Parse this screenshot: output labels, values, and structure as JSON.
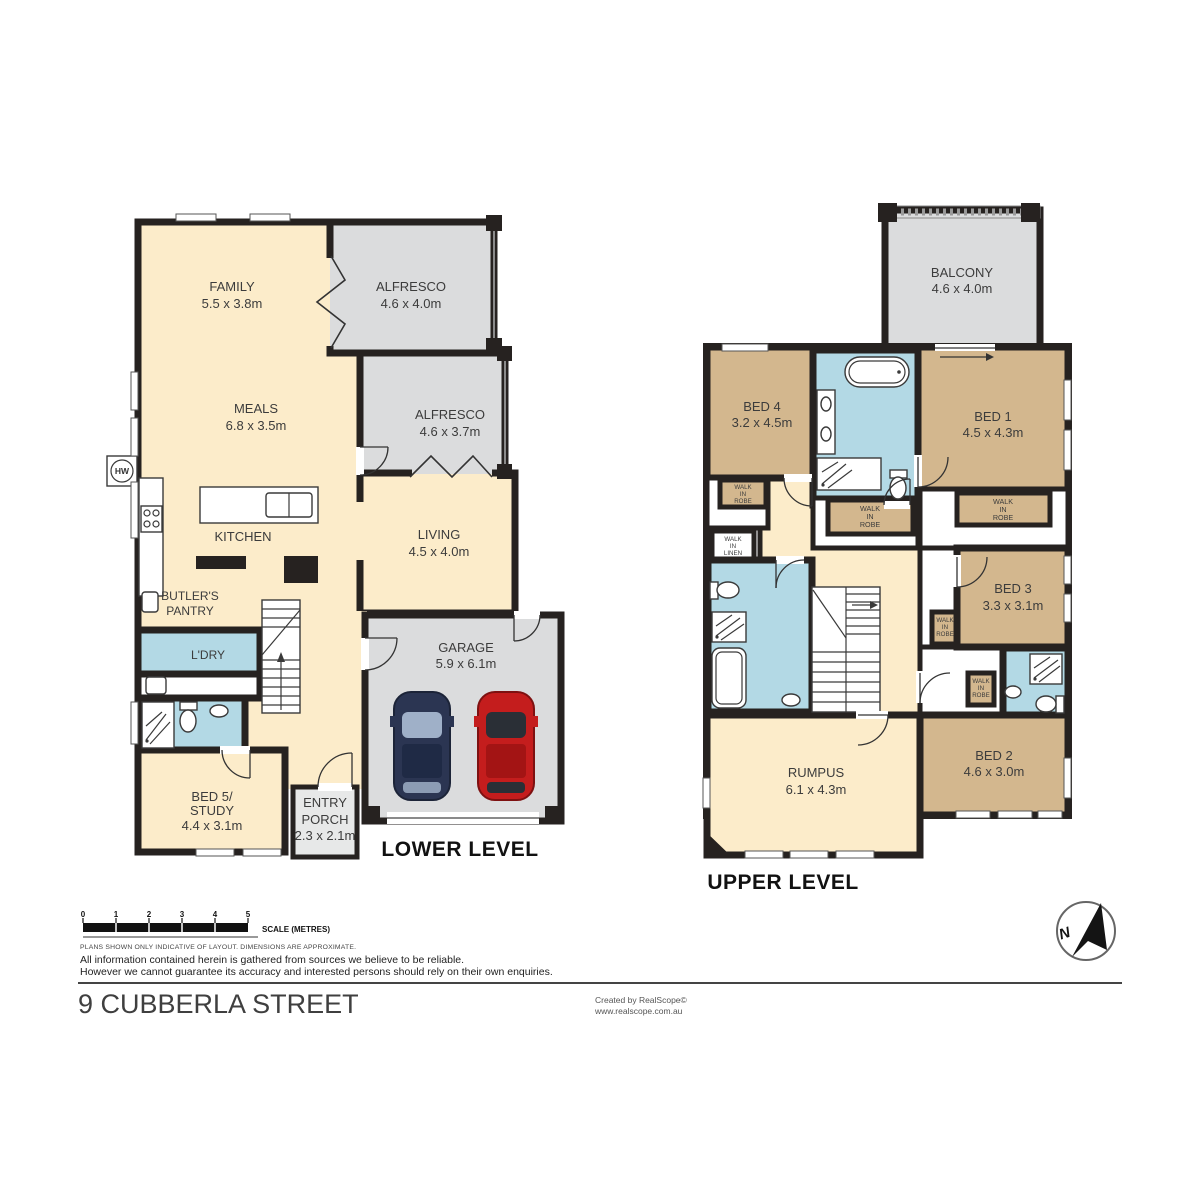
{
  "page": {
    "address": "9 CUBBERLA STREET",
    "credit_line1": "Created by RealScope©",
    "credit_line2": "www.realscope.com.au"
  },
  "levels": {
    "lower": {
      "title": "LOWER LEVEL",
      "rooms": {
        "family": {
          "name": "FAMILY",
          "dims": "5.5 x 3.8m"
        },
        "alfresco_top": {
          "name": "ALFRESCO",
          "dims": "4.6 x 4.0m"
        },
        "meals": {
          "name": "MEALS",
          "dims": "6.8 x 3.5m"
        },
        "alfresco_mid": {
          "name": "ALFRESCO",
          "dims": "4.6 x 3.7m"
        },
        "kitchen": {
          "name": "KITCHEN"
        },
        "living": {
          "name": "LIVING",
          "dims": "4.5 x 4.0m"
        },
        "butlers_pantry": {
          "name1": "BUTLER'S",
          "name2": "PANTRY"
        },
        "laundry": {
          "name": "L'DRY"
        },
        "garage": {
          "name": "GARAGE",
          "dims": "5.9 x 6.1m"
        },
        "bed5_study": {
          "name1": "BED 5/",
          "name2": "STUDY",
          "dims": "4.4 x 3.1m"
        },
        "entry_porch": {
          "name1": "ENTRY",
          "name2": "PORCH",
          "dims": "2.3 x 2.1m"
        },
        "hot_water": {
          "abbr": "HW"
        }
      }
    },
    "upper": {
      "title": "UPPER LEVEL",
      "rooms": {
        "balcony": {
          "name": "BALCONY",
          "dims": "4.6 x 4.0m"
        },
        "bed4": {
          "name": "BED 4",
          "dims": "3.2 x 4.5m"
        },
        "bed1": {
          "name": "BED 1",
          "dims": "4.5 x 4.3m"
        },
        "bed3": {
          "name": "BED 3",
          "dims": "3.3 x 3.1m"
        },
        "bed2": {
          "name": "BED 2",
          "dims": "4.6 x 3.0m"
        },
        "rumpus": {
          "name": "RUMPUS",
          "dims": "6.1 x 4.3m"
        }
      },
      "closets": {
        "walk_in_robe": [
          "WALK",
          "IN",
          "ROBE"
        ],
        "walk_in_linen": [
          "WALK",
          "IN",
          "LINEN"
        ]
      }
    }
  },
  "scale_bar": {
    "ticks": [
      "0",
      "1",
      "2",
      "3",
      "4",
      "5"
    ],
    "label": "SCALE (METRES)"
  },
  "notes": {
    "plans": "PLANS SHOWN ONLY INDICATIVE OF LAYOUT.  DIMENSIONS ARE APPROXIMATE.",
    "line1": "All information contained herein is gathered from sources we believe to be reliable.",
    "line2": "However we cannot guarantee its accuracy and interested persons should rely on their own enquiries."
  },
  "compass": {
    "direction_label": "N"
  },
  "colors": {
    "interior": "#fcecca",
    "outdoor": "#dbdcdd",
    "bedroom": "#d3b78e",
    "wet_area": "#b3d9e5",
    "porch": "#e7e8e8",
    "wall": "#262220",
    "car_navy": "#2b3552",
    "car_red": "#c41d1d"
  }
}
